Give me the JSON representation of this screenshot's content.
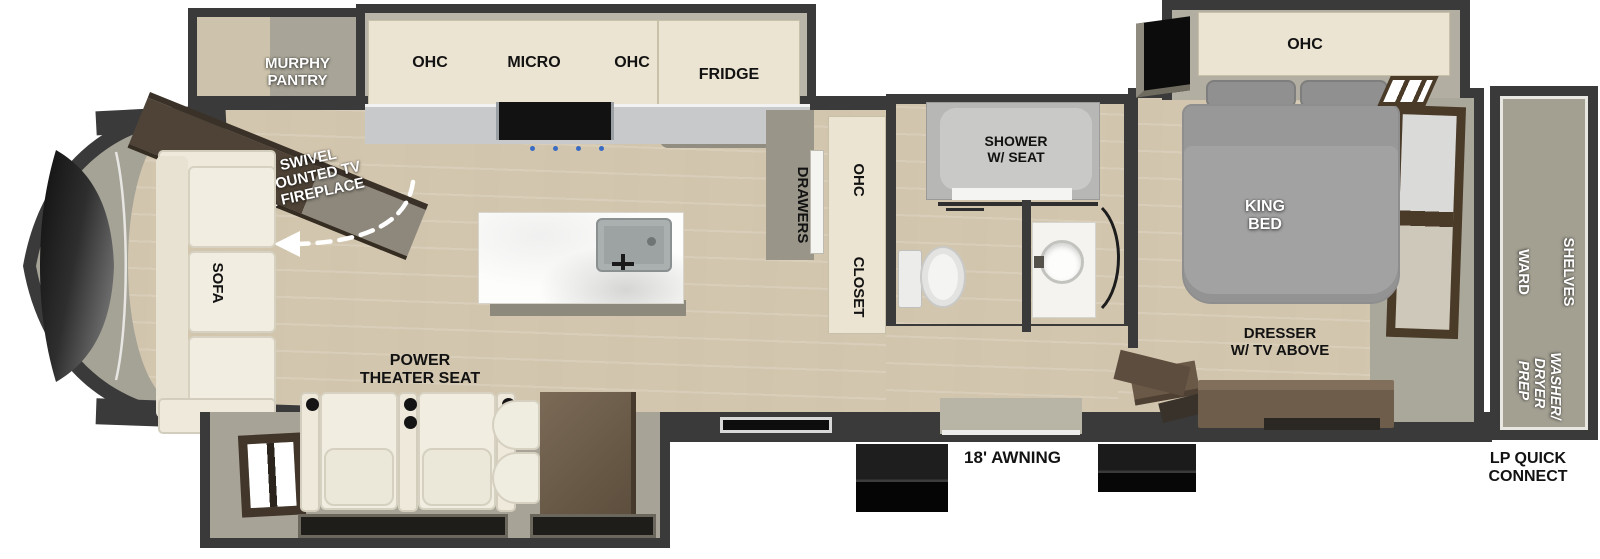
{
  "title": "Fifth Wheel RV Floorplan",
  "colors": {
    "wall": "#3a3a3a",
    "floor_wood": "#d8ccb5",
    "slide_floor": "#a7a396",
    "cabinet_cream": "#ece4d2",
    "furniture_brown": "#6b5a48",
    "bed_gray": "#a2a2a2",
    "upholstery_white": "#f1ede0",
    "burner_blue": "#3a6bc4"
  },
  "front_lounge": {
    "sofa_label": "SOFA",
    "murphy_pantry_label": "MURPHY\nPANTRY",
    "swivel_label": "SWIVEL\nMOUNTED TV\n& FIREPLACE"
  },
  "kitchen": {
    "ohc_left_label": "OHC",
    "micro_label": "MICRO",
    "ohc_right_label": "OHC",
    "fridge_label": "FRIDGE",
    "drawers_label": "DRAWERS",
    "ohc_vertical_label": "OHC",
    "closet_label": "CLOSET"
  },
  "living": {
    "theater_seat_label": "POWER\nTHEATER SEAT"
  },
  "bathroom": {
    "shower_label": "SHOWER\nW/ SEAT"
  },
  "bedroom": {
    "ohc_label": "OHC",
    "king_bed_label": "KING\nBED",
    "dresser_label": "DRESSER\nW/ TV ABOVE"
  },
  "rear_closet": {
    "shelves_label": "SHELVES",
    "ward_label": "WARD",
    "washer_dryer_label": "WASHER/\nDRYER\nPREP"
  },
  "exterior": {
    "awning_label": "18' AWNING",
    "lp_label": "LP QUICK\nCONNECT"
  }
}
